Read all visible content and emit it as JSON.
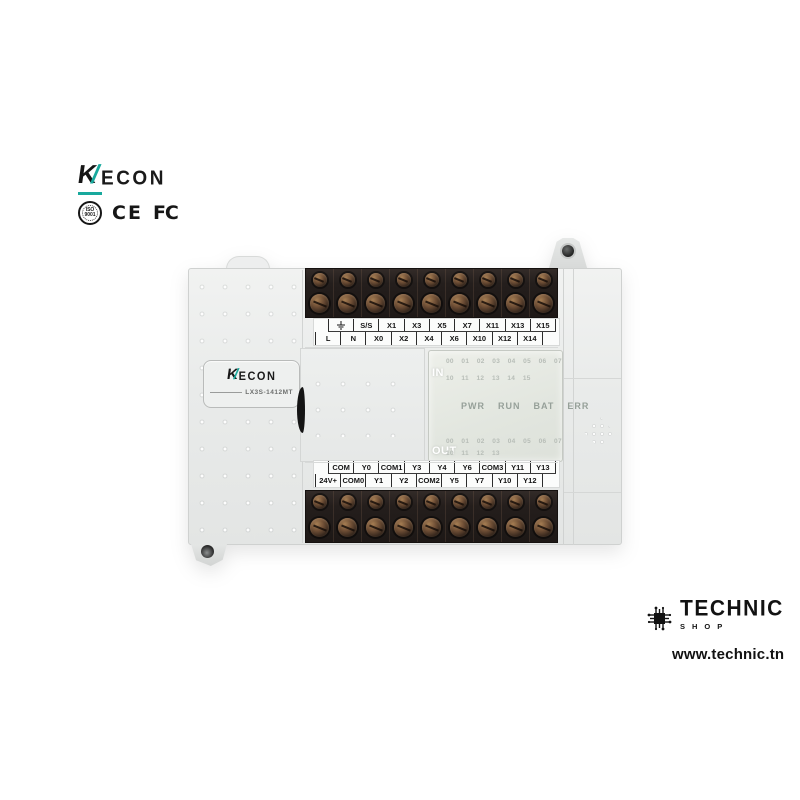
{
  "brand": {
    "full_name": "WECON",
    "logo": {
      "prefix": "K",
      "slash": "/",
      "suffix": "ECON",
      "accent_color": "#18a99d"
    },
    "certifications": {
      "iso_line1": "ISO",
      "iso_line2": "9001",
      "ce": "CE",
      "fcc": "FC"
    }
  },
  "plc": {
    "badge": {
      "logo_prefix": "K",
      "logo_slash": "/",
      "logo_suffix": "ECON",
      "model": "LX3S-1412MT"
    },
    "top_labels": {
      "row1_icon": "earth-ground-icon",
      "row1": [
        "S/S",
        "X1",
        "X3",
        "X5",
        "X7",
        "X11",
        "X13",
        "X15"
      ],
      "row2": [
        "L",
        "N",
        "X0",
        "X2",
        "X4",
        "X6",
        "X10",
        "X12",
        "X14"
      ]
    },
    "bottom_labels": {
      "row1": [
        "COM",
        "Y0",
        "COM1",
        "Y3",
        "Y4",
        "Y6",
        "COM3",
        "Y11",
        "Y13"
      ],
      "row2": [
        "24V+",
        "COM0",
        "Y1",
        "Y2",
        "COM2",
        "Y5",
        "Y7",
        "Y10",
        "Y12"
      ]
    },
    "led_window": {
      "in_label": "IN",
      "in_row1": "00 01 02 03 04 05 06 07",
      "in_row2": "10 11 12 13 14 15",
      "status": [
        "PWR",
        "RUN",
        "BAT",
        "ERR"
      ],
      "out_label": "OUT",
      "out_row1": "00 01 02 03 04 05 06 07",
      "out_row2": "10 11 12 13"
    }
  },
  "seller": {
    "name": "TECHNIC",
    "sub": "SHOP",
    "url": "www.technic.tn",
    "chip_icon": "circuit-chip-icon"
  },
  "colors": {
    "accent_teal": "#18a99d",
    "body_gray": "#e9ebea",
    "terminal_dark": "#241e1c",
    "led_panel": "#e2e6df"
  }
}
